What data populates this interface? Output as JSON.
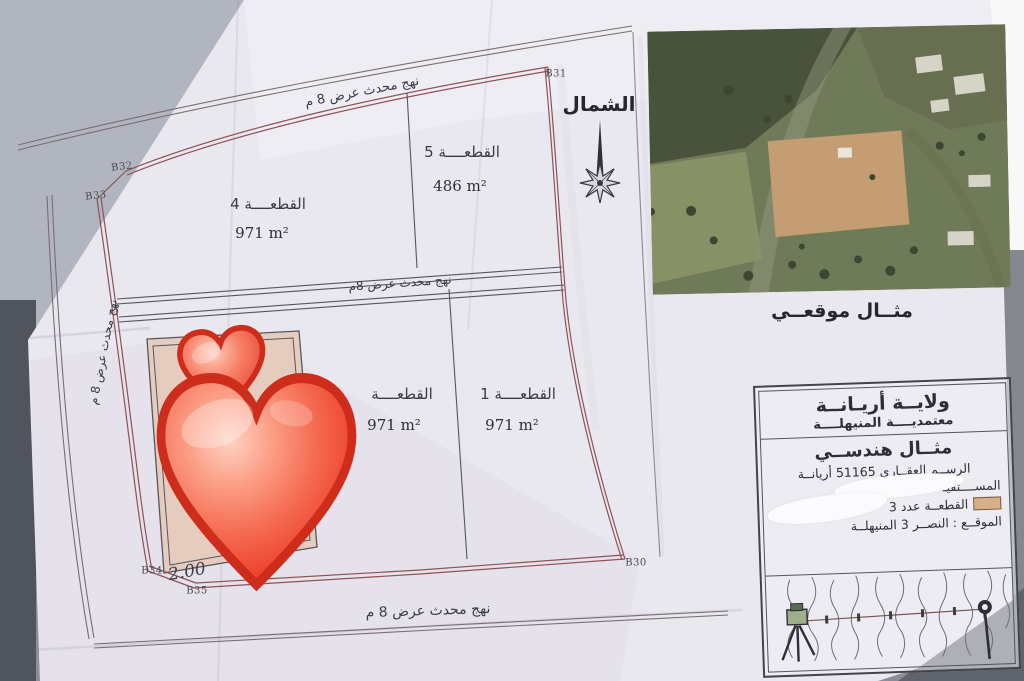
{
  "plan": {
    "north_label": "الشمال",
    "roads": {
      "top_label": "نهج محدث عرض 8 م",
      "middle_label": "نهج محدث  عرض 8م",
      "left_label": "نهج محدث عرض 8 م",
      "bottom_label": "نهج محدث  عرض 8 م"
    },
    "plots": [
      {
        "name": "القطعــــة  5",
        "area": "486 m²"
      },
      {
        "name": "القطعــــة  4",
        "area": "971 m²"
      },
      {
        "name": "القطعــــة  1",
        "area": "971 m²"
      },
      {
        "name": "القطعــــة",
        "area": "971 m²"
      }
    ],
    "markers": {
      "b31": "B31",
      "b32": "B32",
      "b33": "B33",
      "b34": "B34",
      "b35": "B35",
      "b30": "B30"
    },
    "handwritten": {
      "left": "2.00",
      "right": "50"
    }
  },
  "inset": {
    "caption": "مثــال موقعــي"
  },
  "title_block": {
    "governorate": "ولايــة أريـانــة",
    "delegation": "معتمديــــة المنيهلــــة",
    "doc_type": "مثــال هندســي",
    "registry": "الرســم العقــاري 51165 أريانــة",
    "beneficiary": "المســــتفيـ",
    "plot_line": "القطعــة عدد 3",
    "location": "الموقــع : النصــر 3  المنيهلــة"
  },
  "colors": {
    "boundary_red": "#8f5156",
    "plot3_fill": "#e5ccbe",
    "legend_swatch": "#d9af8a",
    "heart_red": "#ee4a33",
    "paper": "#e9e8ef"
  }
}
